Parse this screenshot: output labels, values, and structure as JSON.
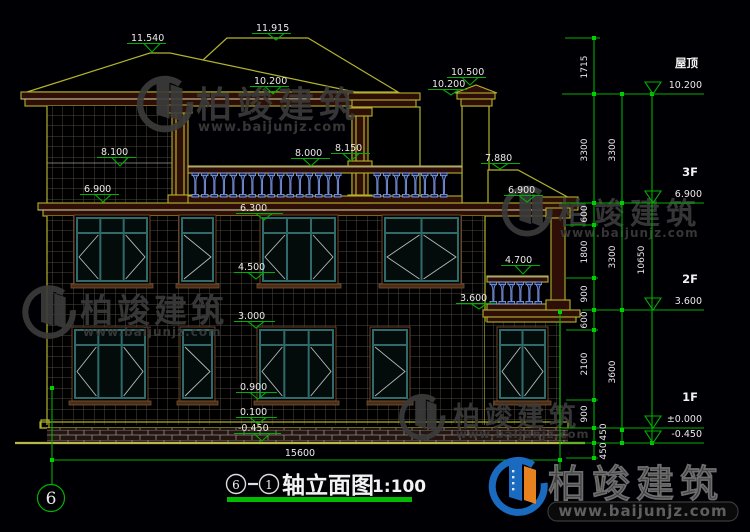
{
  "title_bar": {
    "axis_from": "6",
    "axis_to": "1",
    "title": "轴立面图",
    "scale": "1:100"
  },
  "axis_bubble": "6",
  "bottom_dim": "15600",
  "levels": {
    "l11540": "11.540",
    "l11915": "11.915",
    "l10500": "10.500",
    "l10200a": "10.200",
    "l10200b": "10.200",
    "l8100": "8.100",
    "l8000": "8.000",
    "l8150": "8.150",
    "l7880": "7.880",
    "l6900a": "6.900",
    "l6900b": "6.900",
    "l6300": "6.300",
    "l4700": "4.700",
    "l4500": "4.500",
    "l3600": "3.600",
    "l3000": "3.000",
    "l0900": "0.900",
    "l0100": "0.100",
    "lm0450": "-0.450"
  },
  "dim_cols": {
    "col1": [
      "1715",
      "3300",
      "600",
      "1800",
      "900",
      "600",
      "2100",
      "900",
      "450",
      "450"
    ],
    "col2": [
      "3300",
      "3300",
      "3600"
    ],
    "col3": [
      "10650"
    ]
  },
  "floor_marks": [
    {
      "name": "屋顶",
      "elev": "10.200"
    },
    {
      "name": "3F",
      "elev": "6.900"
    },
    {
      "name": "2F",
      "elev": "3.600"
    },
    {
      "name": "1F",
      "elev": "±0.000"
    },
    {
      "name": "",
      "elev": "-0.450"
    }
  ],
  "watermarks": {
    "brand": "柏竣建筑",
    "url": "www.baijunjz.com"
  },
  "footer_logo": {
    "brand": "柏竣建筑",
    "url": "www.baijunjz.com"
  },
  "colors": {
    "background": "#000004",
    "cad_yellow": "#b2b22c",
    "dim_green": "#00b000",
    "title_underline": "#00bb00",
    "window_teal": "#2f6b6b",
    "baluster_blue": "#7b96e0",
    "watermark_gray": "#3b3b3b",
    "logo_blue": "#1a6bc0",
    "logo_orange": "#e8821e",
    "text_white": "#e9e9e9"
  }
}
